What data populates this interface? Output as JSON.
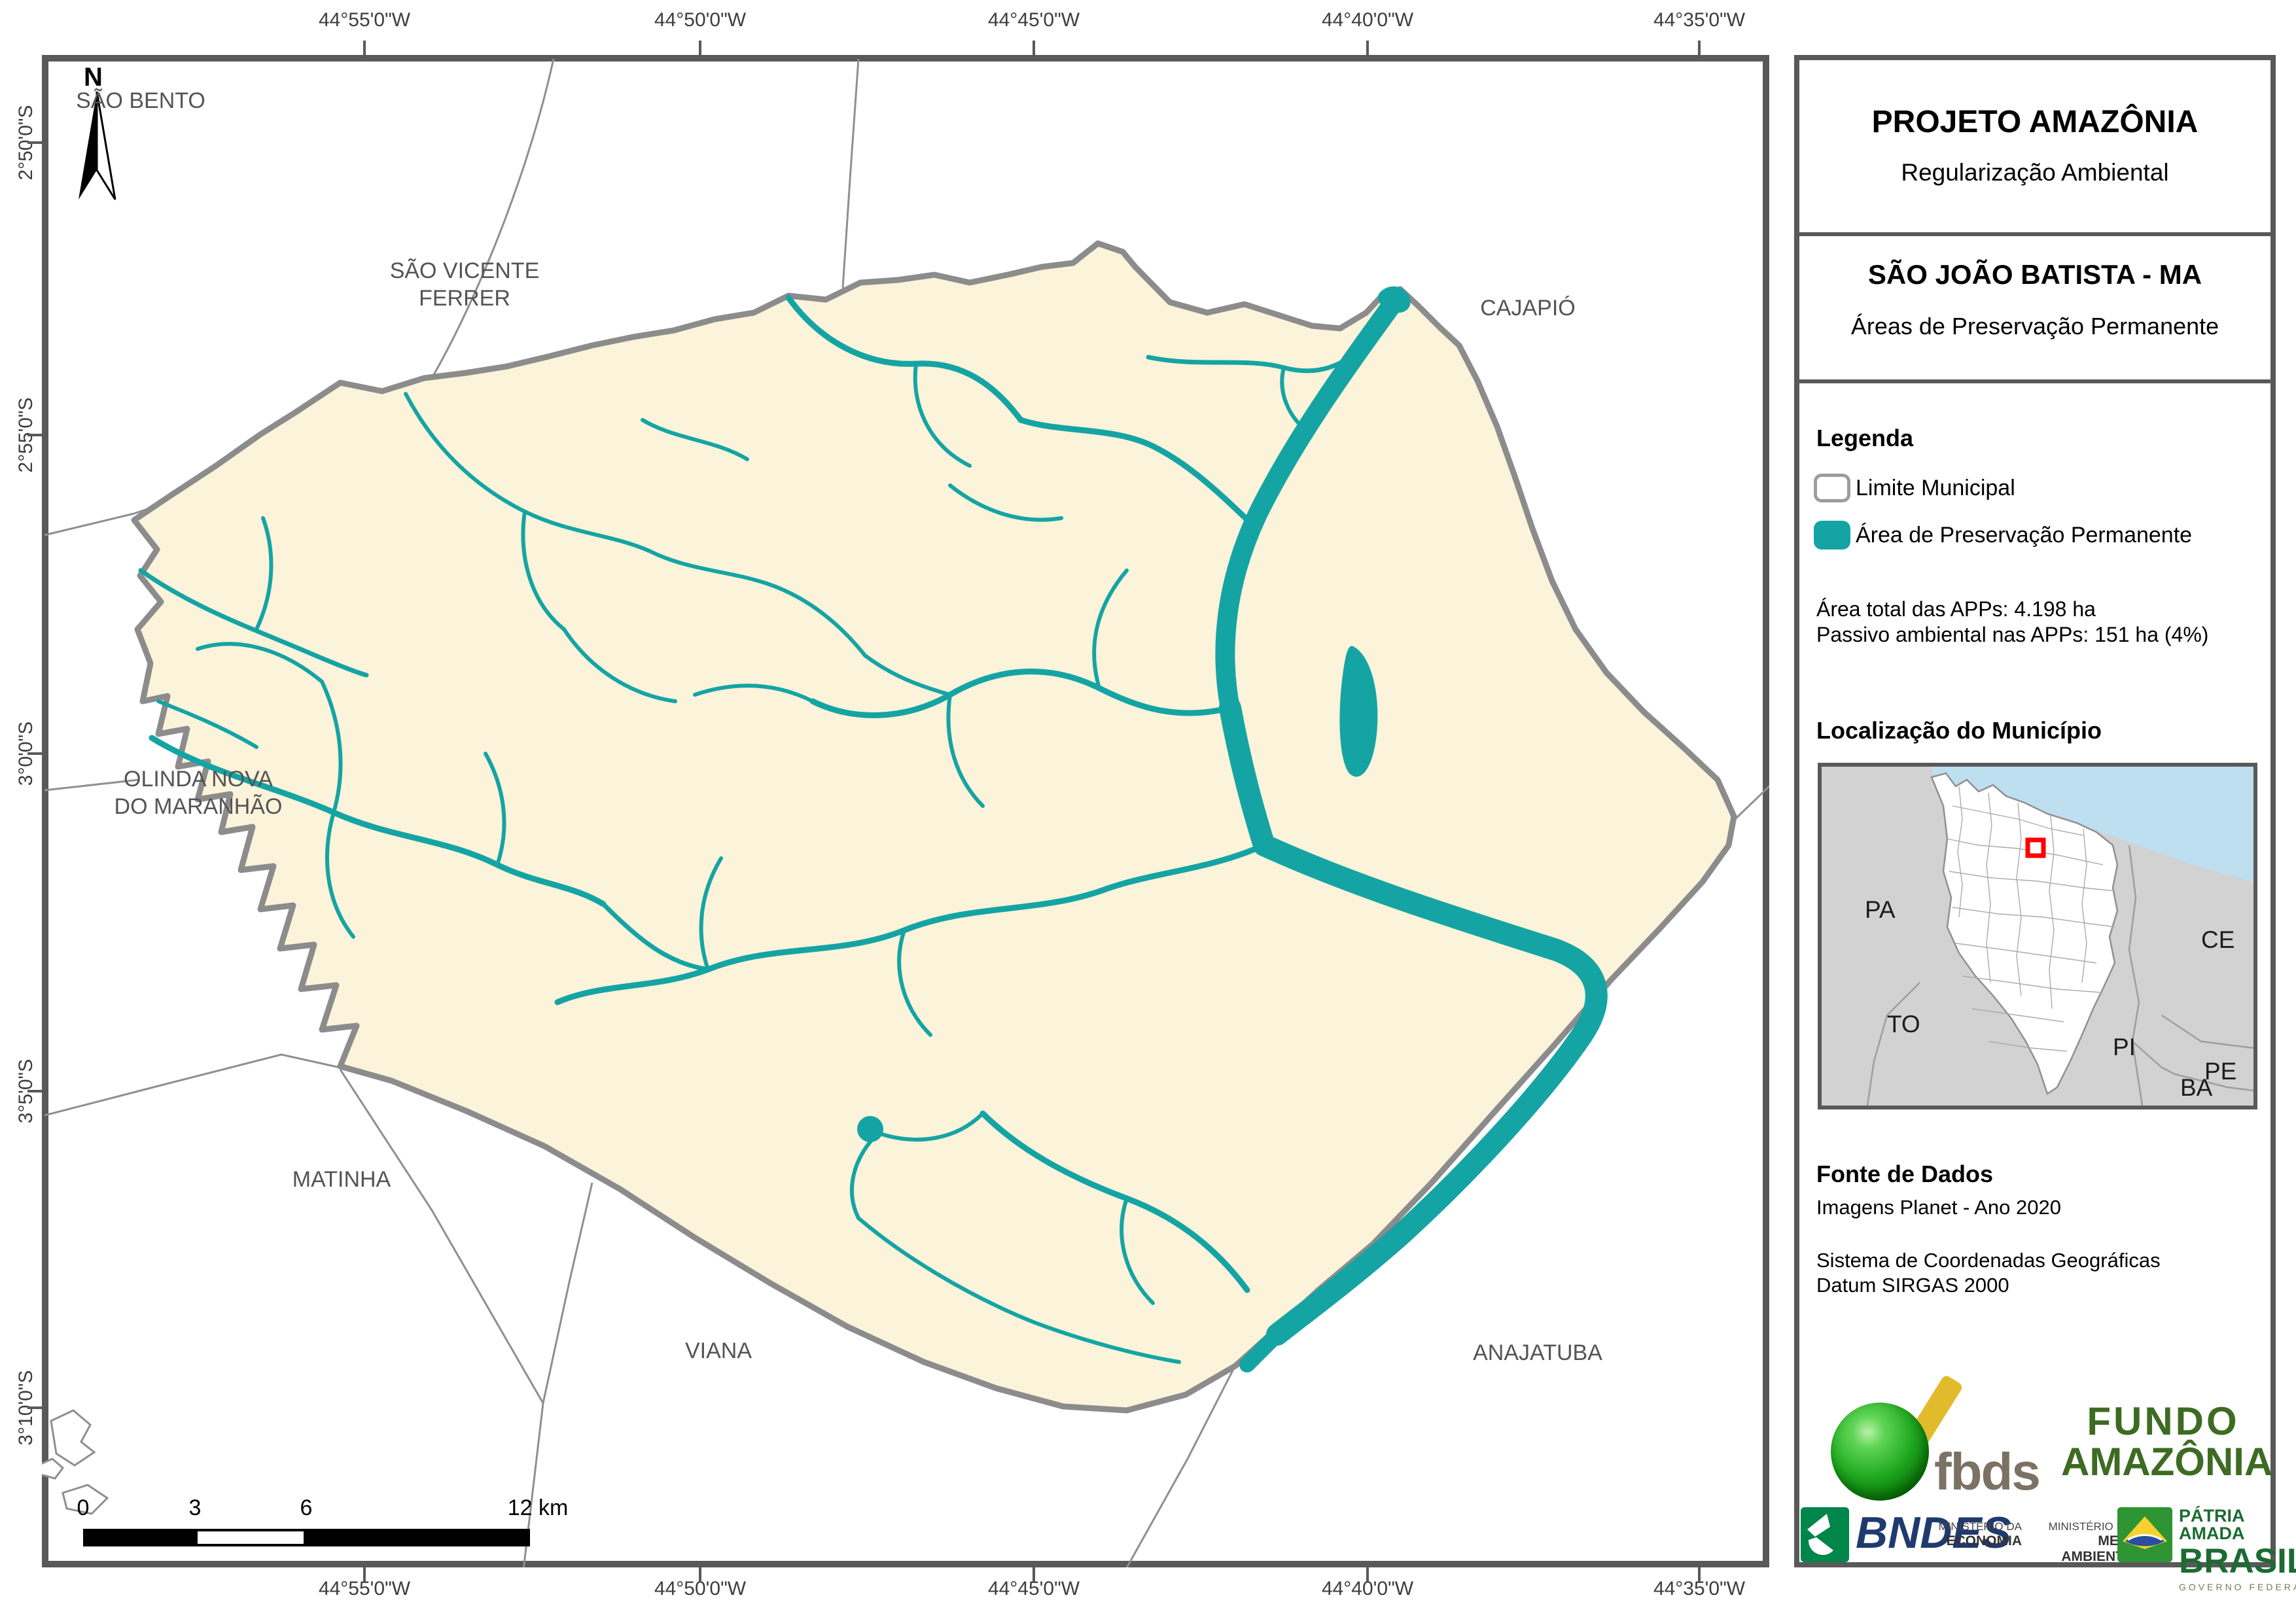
{
  "colors": {
    "app_teal": "#15A4A4",
    "municipality_fill": "#FBF3DA",
    "frame_gray": "#595959",
    "boundary_gray": "#8C8C8C",
    "ocean_blue": "#BEDFEF",
    "land_gray": "#D2D2D2",
    "marker_red": "#FF0000",
    "bndes_blue": "#1F3A6E",
    "bndes_green": "#00854A",
    "gov_green": "#1C6B33",
    "fbds_text": "#7B7264",
    "fbds_yellow": "#E2BB2D",
    "fundo_green": "#3E6B22"
  },
  "map": {
    "north_label": "N",
    "top_axis": [
      "44°55'0\"W",
      "44°50'0\"W",
      "44°45'0\"W",
      "44°40'0\"W",
      "44°35'0\"W"
    ],
    "bottom_axis": [
      "44°55'0\"W",
      "44°50'0\"W",
      "44°45'0\"W",
      "44°40'0\"W",
      "44°35'0\"W"
    ],
    "left_axis": [
      "2°50'0\"S",
      "2°55'0\"S",
      "3°0'0\"S",
      "3°5'0\"S",
      "3°10'0\"S"
    ],
    "place_labels": {
      "sao_bento": "SÃO BENTO",
      "sao_vicente_ferrer": "SÃO VICENTE\nFERRER",
      "cajapio": "CAJAPIÓ",
      "olinda_nova": "OLINDA NOVA\nDO MARANHÃO",
      "matinha": "MATINHA",
      "viana": "VIANA",
      "anajatuba": "ANAJATUBA"
    },
    "scale_bar": {
      "tick0": "0",
      "tick3": "3",
      "tick6": "6",
      "tick12": "12 km"
    }
  },
  "sidebar": {
    "title": "PROJETO AMAZÔNIA",
    "subtitle": "Regularização Ambiental",
    "municipality": "SÃO JOÃO BATISTA - MA",
    "map_subject": "Áreas de Preservação Permanente",
    "legend": {
      "header": "Legenda",
      "items": [
        {
          "label": "Limite Municipal"
        },
        {
          "label": "Área de Preservação Permanente"
        }
      ],
      "stats": [
        "Área total das APPs: 4.198 ha",
        "Passivo ambiental nas APPs: 151 ha (4%)"
      ]
    },
    "location": {
      "header": "Localização do Município",
      "state_labels": [
        "PA",
        "CE",
        "PI",
        "PE",
        "BA",
        "TO"
      ]
    },
    "source": {
      "header": "Fonte de Dados",
      "lines": [
        "Imagens Planet - Ano 2020",
        "Sistema de Coordenadas Geográficas",
        "Datum SIRGAS 2000"
      ]
    },
    "logos": {
      "fbds": "fbds",
      "fundo_line1": "FUNDO",
      "fundo_line2": "AMAZÔNIA",
      "bndes": "BNDES",
      "min_economia_l1": "MINISTÉRIO DA",
      "min_economia_l2": "ECONOMIA",
      "min_meio_l1": "MINISTÉRIO DO",
      "min_meio_l2": "MEIO AMBIENTE",
      "patria_line1": "PÁTRIA AMADA",
      "patria_line2": "BRASIL",
      "patria_line3": "GOVERNO FEDERAL"
    }
  }
}
